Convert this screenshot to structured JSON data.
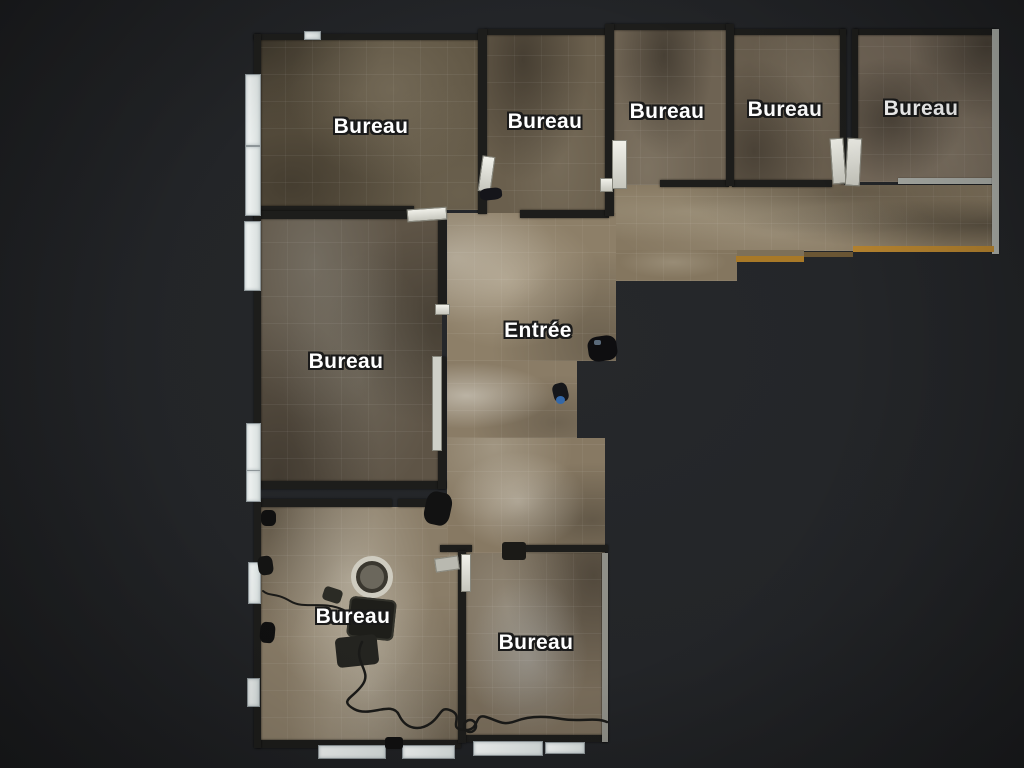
{
  "scene": {
    "view": "floorplan-top-view",
    "language": "fr"
  },
  "rooms": [
    {
      "id": "bureau-top-1",
      "label": "Bureau"
    },
    {
      "id": "bureau-top-2",
      "label": "Bureau"
    },
    {
      "id": "bureau-top-3",
      "label": "Bureau"
    },
    {
      "id": "bureau-top-4",
      "label": "Bureau"
    },
    {
      "id": "bureau-top-5",
      "label": "Bureau"
    },
    {
      "id": "bureau-mid-left",
      "label": "Bureau"
    },
    {
      "id": "entree",
      "label": "Entrée"
    },
    {
      "id": "bureau-bottom-left",
      "label": "Bureau"
    },
    {
      "id": "bureau-bottom-center",
      "label": "Bureau"
    }
  ],
  "colors": {
    "background": "#232528",
    "wall_dark": "#1d1d1b",
    "wall_light": "#a9aca6",
    "window_sill": "#e7ebea",
    "floor_dark_brown": "#5f5543",
    "floor_mid_brown": "#6e6353",
    "floor_light_beige": "#8a7d68",
    "accent_orange": "#b5832f",
    "label_text": "#ffffff",
    "label_outline": "#1a1a1a",
    "cable": "#1a1a18"
  }
}
